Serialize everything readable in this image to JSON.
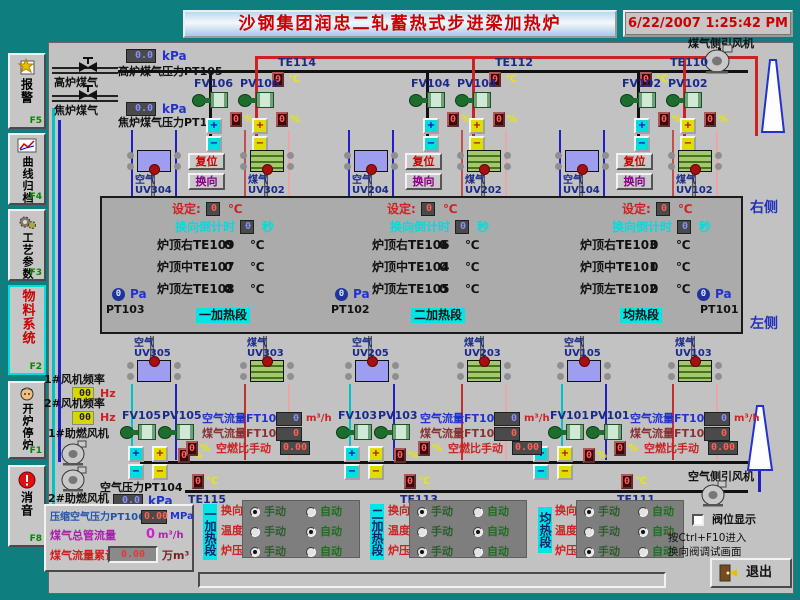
{
  "window": {
    "title": "沙钢集团润忠二轧蓄热式步进梁加热炉",
    "datetime": "6/22/2007 1:25:42 PM"
  },
  "colors": {
    "frame_teal": "#0e7e7e",
    "panel_gray": "#c2c2c2",
    "furnace_gray": "#ababab",
    "title_red": "#cc0000",
    "cyan_accent": "#00e5e5",
    "navy_label": "#1a2a8a",
    "yellow_unit": "#e8e800"
  },
  "icons": {
    "plus": "+",
    "minus": "−"
  },
  "labels": {
    "air": "空气",
    "gas": "煤气",
    "reset": "复位",
    "reverse": "换向",
    "manual": "手动",
    "auto": "自动",
    "right_side": "右侧",
    "left_side": "左侧"
  },
  "sidebar": [
    {
      "label": "报警",
      "fkey": "F5",
      "icon": "alarm-report"
    },
    {
      "label": "曲线归档",
      "fkey": "F4",
      "icon": "trend-curve"
    },
    {
      "label": "工艺参数",
      "fkey": "F3",
      "icon": "process-gears"
    },
    {
      "label": "物料系统",
      "fkey": "F2",
      "icon": "none",
      "active": true
    },
    {
      "label": "开炉停炉",
      "fkey": "F1",
      "icon": "operator-face"
    },
    {
      "label": "消音",
      "fkey": "F8",
      "icon": "mute-exclaim"
    }
  ],
  "gas_supply": [
    {
      "pipe": "高炉煤气",
      "value": "0.0",
      "unit": "kPa",
      "tag": "高炉煤气压力PT105"
    },
    {
      "pipe": "焦炉煤气",
      "value": "0.0",
      "unit": "kPa",
      "tag": "焦炉煤气压力PT107"
    }
  ],
  "fans": {
    "gas_side": "煤气侧引风机",
    "air_side": "空气侧引风机",
    "comb1": "1#助燃风机",
    "comb2": "2#助燃风机",
    "freq1": {
      "label": "1#风机频率",
      "value": "00",
      "unit": "Hz"
    },
    "freq2": {
      "label": "2#风机频率",
      "value": "00",
      "unit": "Hz"
    }
  },
  "top_groups": [
    {
      "te": "TE114",
      "temp_value": "0",
      "temp_unit": "℃",
      "fv": "FV106",
      "pv": "PV106",
      "fv_pct": "0",
      "pv_pct": "0",
      "pct_unit": "%",
      "air_tag": "UV304",
      "gas_tag": "UV302"
    },
    {
      "te": "TE112",
      "temp_value": "0",
      "temp_unit": "℃",
      "fv": "FV104",
      "pv": "PV104",
      "fv_pct": "0",
      "pv_pct": "0",
      "pct_unit": "%",
      "air_tag": "UV204",
      "gas_tag": "UV202"
    },
    {
      "te": "TE110",
      "temp_value": "0",
      "temp_unit": "℃",
      "fv": "FV102",
      "pv": "PV102",
      "fv_pct": "0",
      "pv_pct": "0",
      "pct_unit": "%",
      "air_tag": "UV104",
      "gas_tag": "UV102"
    }
  ],
  "furnace": {
    "sections": [
      {
        "name": "一加热段",
        "set_label": "设定:",
        "set_value": "0",
        "set_unit": "℃",
        "cd_label": "换向倒计时",
        "cd_value": "0",
        "cd_unit": "秒",
        "temps": [
          {
            "label": "炉顶右TE109",
            "value": "0",
            "unit": "℃"
          },
          {
            "label": "炉顶中TE107",
            "value": "0",
            "unit": "℃"
          },
          {
            "label": "炉顶左TE108",
            "value": "0",
            "unit": "℃"
          }
        ],
        "pressure": {
          "value": "0",
          "unit": "Pa",
          "tag": "PT103"
        }
      },
      {
        "name": "二加热段",
        "set_label": "设定:",
        "set_value": "0",
        "set_unit": "℃",
        "cd_label": "换向倒计时",
        "cd_value": "0",
        "cd_unit": "秒",
        "temps": [
          {
            "label": "炉顶右TE106",
            "value": "0",
            "unit": "℃"
          },
          {
            "label": "炉顶中TE104",
            "value": "0",
            "unit": "℃"
          },
          {
            "label": "炉顶左TE105",
            "value": "0",
            "unit": "℃"
          }
        ],
        "pressure": {
          "value": "0",
          "unit": "Pa",
          "tag": "PT102"
        }
      },
      {
        "name": "均热段",
        "set_label": "设定:",
        "set_value": "0",
        "set_unit": "℃",
        "cd_label": "换向倒计时",
        "cd_value": "0",
        "cd_unit": "秒",
        "temps": [
          {
            "label": "炉顶右TE103",
            "value": "0",
            "unit": "℃"
          },
          {
            "label": "炉顶中TE101",
            "value": "0",
            "unit": "℃"
          },
          {
            "label": "炉顶左TE102",
            "value": "0",
            "unit": "℃"
          }
        ],
        "pressure": {
          "value": "0",
          "unit": "Pa",
          "tag": "PT101"
        }
      }
    ]
  },
  "mid_burners": [
    {
      "label": "空气",
      "tag": "UV305",
      "type": "air"
    },
    {
      "label": "煤气",
      "tag": "UV303",
      "type": "gas"
    },
    {
      "label": "空气",
      "tag": "UV205",
      "type": "air"
    },
    {
      "label": "煤气",
      "tag": "UV203",
      "type": "gas"
    },
    {
      "label": "空气",
      "tag": "UV105",
      "type": "air"
    },
    {
      "label": "煤气",
      "tag": "UV103",
      "type": "gas"
    }
  ],
  "bottom_valves": [
    {
      "fv": "FV105",
      "pv": "PV105",
      "pct": "0",
      "pct_unit": "%"
    },
    {
      "fv": "FV103",
      "pv": "PV103",
      "pct": "0",
      "pct_unit": "%"
    },
    {
      "fv": "FV101",
      "pv": "PV101",
      "pct": "0",
      "pct_unit": "%"
    }
  ],
  "flow_groups": [
    {
      "air_label": "空气流量FT105",
      "air_value": "0",
      "air_unit": "m³/h",
      "gas_label": "煤气流量FT106",
      "gas_value": "0",
      "ratio_label": "空燃比手动",
      "ratio_value": "0.00",
      "ratio_pct": "0",
      "pct_unit": "%"
    },
    {
      "air_label": "空气流量FT103",
      "air_value": "0",
      "air_unit": "m³/h",
      "gas_label": "煤气流量FT104",
      "gas_value": "0",
      "ratio_label": "空燃比手动",
      "ratio_value": "0.00",
      "ratio_pct": "0",
      "pct_unit": "%"
    },
    {
      "air_label": "空气流量FT101",
      "air_value": "0",
      "air_unit": "m³/h",
      "gas_label": "煤气流量FT102",
      "gas_value": "0",
      "ratio_label": "空燃比手动",
      "ratio_value": "0.00",
      "ratio_pct": "0",
      "pct_unit": "%"
    }
  ],
  "air_pressure": {
    "label": "空气压力PT104",
    "value": "0.0",
    "unit": "kPa"
  },
  "flue_temps": [
    {
      "te": "TE115",
      "value": "0",
      "unit": "℃"
    },
    {
      "te": "TE113",
      "value": "0",
      "unit": "℃"
    },
    {
      "te": "TE111",
      "value": "0",
      "unit": "℃"
    }
  ],
  "totals": {
    "comp_air": {
      "label": "压缩空气压力PT106",
      "value": "0.00",
      "unit": "MPa"
    },
    "gas_main": {
      "label": "煤气总管流量",
      "value": "0",
      "unit": "m³/h"
    },
    "gas_total": {
      "label": "煤气流量累计",
      "value": "0.00",
      "unit": "万m³"
    }
  },
  "control": {
    "row_labels": [
      "换向",
      "温度",
      "炉压"
    ],
    "sections": [
      {
        "name": "一加热段",
        "selection": [
          "manual",
          "auto",
          "manual"
        ]
      },
      {
        "name": "二加热段",
        "selection": [
          "manual",
          "auto",
          "manual"
        ]
      },
      {
        "name": "均热段",
        "selection": [
          "manual",
          "auto",
          "manual"
        ]
      }
    ]
  },
  "footer": {
    "valve_display": "阀位显示",
    "hint1": "按Ctrl+F10进入",
    "hint2": "换向阀调试画面",
    "exit": "退出"
  }
}
